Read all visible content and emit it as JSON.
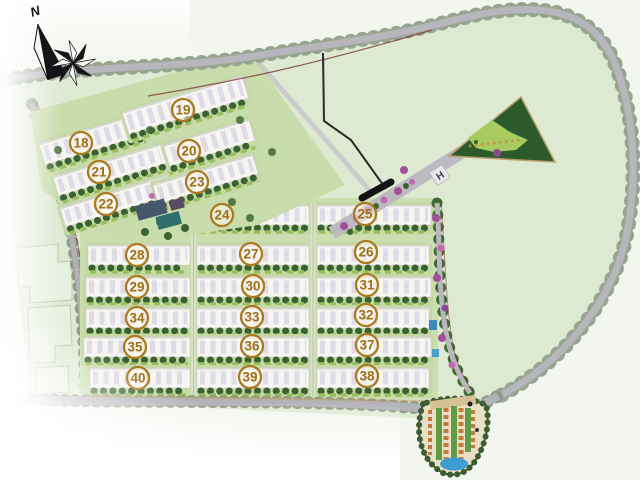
{
  "map": {
    "type": "residential-site-plan",
    "compass": {
      "label": "N"
    },
    "entrance_marker": {
      "label": "H"
    },
    "badge_style": {
      "ring_color": "#ab7a1e",
      "text_color": "#a06f15"
    },
    "blocks": [
      {
        "num": "18",
        "x": 81,
        "y": 143
      },
      {
        "num": "19",
        "x": 183,
        "y": 110
      },
      {
        "num": "20",
        "x": 189,
        "y": 151
      },
      {
        "num": "21",
        "x": 99,
        "y": 172
      },
      {
        "num": "22",
        "x": 106,
        "y": 204
      },
      {
        "num": "23",
        "x": 197,
        "y": 182
      },
      {
        "num": "24",
        "x": 222,
        "y": 215
      },
      {
        "num": "25",
        "x": 365,
        "y": 214
      },
      {
        "num": "28",
        "x": 137,
        "y": 255
      },
      {
        "num": "27",
        "x": 251,
        "y": 254
      },
      {
        "num": "26",
        "x": 366,
        "y": 252
      },
      {
        "num": "29",
        "x": 137,
        "y": 287
      },
      {
        "num": "30",
        "x": 253,
        "y": 286
      },
      {
        "num": "31",
        "x": 367,
        "y": 285
      },
      {
        "num": "34",
        "x": 137,
        "y": 318
      },
      {
        "num": "33",
        "x": 252,
        "y": 317
      },
      {
        "num": "32",
        "x": 366,
        "y": 315
      },
      {
        "num": "35",
        "x": 135,
        "y": 347
      },
      {
        "num": "36",
        "x": 252,
        "y": 346
      },
      {
        "num": "37",
        "x": 367,
        "y": 345
      },
      {
        "num": "40",
        "x": 138,
        "y": 378
      },
      {
        "num": "39",
        "x": 250,
        "y": 377
      },
      {
        "num": "38",
        "x": 367,
        "y": 376
      }
    ],
    "palette": {
      "site_green": "#dee9d2",
      "grass": "#c9dcaa",
      "building_white": "#f6f5f1",
      "tree_dark": "#3a6130",
      "road_gray": "#b7b6bc",
      "tree_line": "#97a48f",
      "park_dark": "#2d5a2b",
      "park_lawn": "#a8cb60",
      "water_blue": "#3e9ed2",
      "flower_purple": "#a44f9e",
      "boundary_black": "#2a2a2a",
      "boundary_red": "#7c3836"
    }
  }
}
